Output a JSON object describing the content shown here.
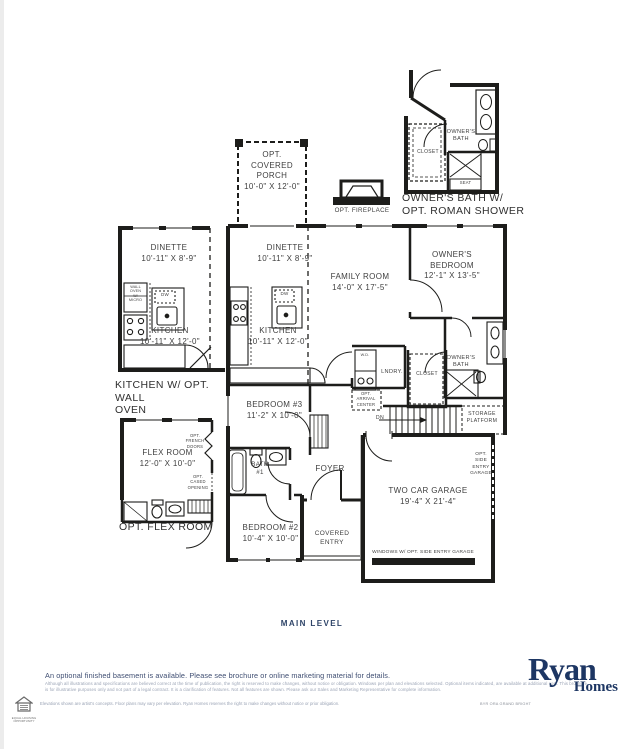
{
  "rooms": {
    "porch": "OPT.\nCOVERED\nPORCH\n10'-0\" X 12'-0\"",
    "fireplace": "OPT. FIREPLACE",
    "dinette_opt": "DINETTE\n10'-11\" X 8'-9\"",
    "kitchen_opt": "KITCHEN\n10'-11\" X 12'-0\"",
    "wall_oven": "WALL\nOVEN\nW/\nMICRO",
    "dw": "DW",
    "dinette": "DINETTE\n10'-11\" X 8'-9\"",
    "kitchen": "KITCHEN\n10'-11\" X 12'-0\"",
    "family_room": "FAMILY ROOM\n14'-0\" X 17'-5\"",
    "owners_bedroom": "OWNER'S\nBEDROOM\n12'-1\" X 13'-5\"",
    "owners_bath": "OWNER'S\nBATH",
    "closet": "CLOSET",
    "seat": "SEAT",
    "washer_dryer": "W.D.",
    "laundry": "LNDRY.",
    "arrival_center": "OPT.\nARRIVAL\nCENTER",
    "down": "DN",
    "storage_platform": "STORAGE\nPLATFORM",
    "bedroom3": "BEDROOM #3\n11'-2\" X 10'-0\"",
    "flex_room": "FLEX ROOM\n12'-0\" X 10'-0\"",
    "french_doors": "OPT.\nFRENCH\nDOORS",
    "cased_opening": "OPT.\nCASED\nOPENING",
    "bath1": "BATH\n#1",
    "foyer": "FOYER",
    "bedroom2": "BEDROOM #2\n10'-4\" X 10'-0\"",
    "covered_entry": "COVERED\nENTRY",
    "garage": "TWO CAR GARAGE\n19'-4\" X 21'-4\"",
    "side_entry_garage": "OPT.\nSIDE\nENTRY\nGARAGE",
    "windows_note": "WINDOWS W/ OPT. SIDE ENTRY GARAGE"
  },
  "captions": {
    "owners_bath_option": "OWNER'S BATH W/\nOPT. ROMAN SHOWER",
    "kitchen_option": "KITCHEN W/ OPT. WALL\nOVEN",
    "flex_option": "OPT. FLEX ROOM",
    "level": "MAIN LEVEL"
  },
  "footer": {
    "note": "An optional finished basement is available. Please see brochure or online marketing material for details.",
    "fine_print": "Although all illustrations and specifications are believed correct at the time of publication, the right is reserved to make changes, without notice or obligation. Windows per plan and elevations selected. Optional items indicated, are available at additional cost. This brochure is for illustrative purposes only and not part of a legal contract. It is a clarification of features. Not all features are shown. Please ask our Sales and Marketing Representative for complete information.",
    "fine_print_2": "Elevations shown are artist's concepts. Floor plans may vary per elevation. Ryan Homes reserves the right to make changes without notice or prior obligation.",
    "plan_code": "BYR ORA GRAND BRIGHT",
    "equal_housing": "EQUAL HOUSING\nOPPORTUNITY",
    "logo_top": "Ryan",
    "logo_bottom": "Homes"
  },
  "colors": {
    "wall": "#1d1d1b",
    "navy": "#23406e",
    "label": "#3f3f3f"
  }
}
